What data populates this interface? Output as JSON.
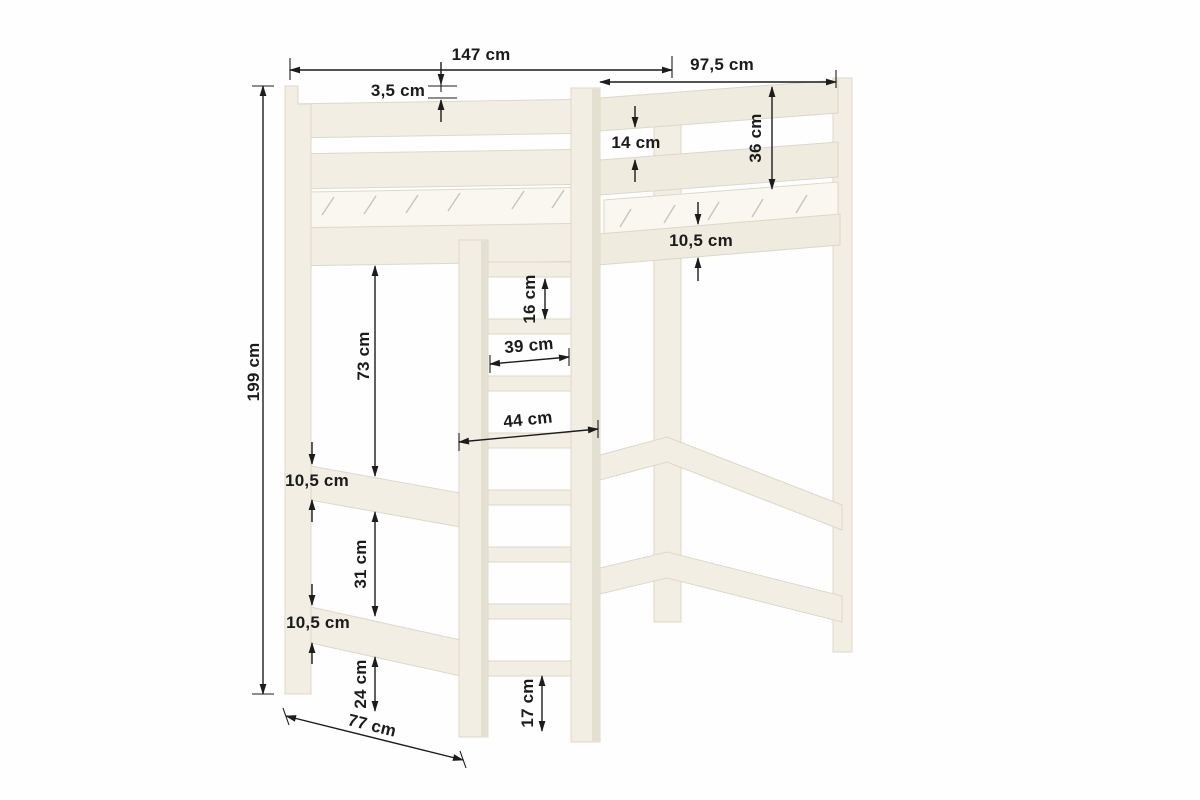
{
  "diagram": {
    "subject": "Loft bed with ladder - dimensional drawing",
    "unit": "cm",
    "colors": {
      "wood": "#f2eee3",
      "wood_shaded": "#efebdf",
      "wood_outline": "#ddd8c7",
      "mattress": "#f9f7ef",
      "dimension_ink": "#1c1c1c",
      "background": "#ffffff"
    },
    "dimensions": {
      "total_width": "147 cm",
      "top_rail_thickness": "3,5 cm",
      "upper_depth": "97,5 cm",
      "rail_gap": "14 cm",
      "guard_rail_height": "36 cm",
      "bed_frame_thickness": "10,5 cm",
      "total_height": "199 cm",
      "under_bed_clearance": "73 cm",
      "ladder_rung_spacing": "16 cm",
      "ladder_inner_width": "39 cm",
      "ladder_outer_width": "44 cm",
      "side_rail_thickness_upper": "10,5 cm",
      "side_rail_gap": "31 cm",
      "side_rail_thickness_lower": "10,5 cm",
      "floor_clearance": "24 cm",
      "ladder_floor_gap": "17 cm",
      "base_depth": "77 cm"
    }
  }
}
